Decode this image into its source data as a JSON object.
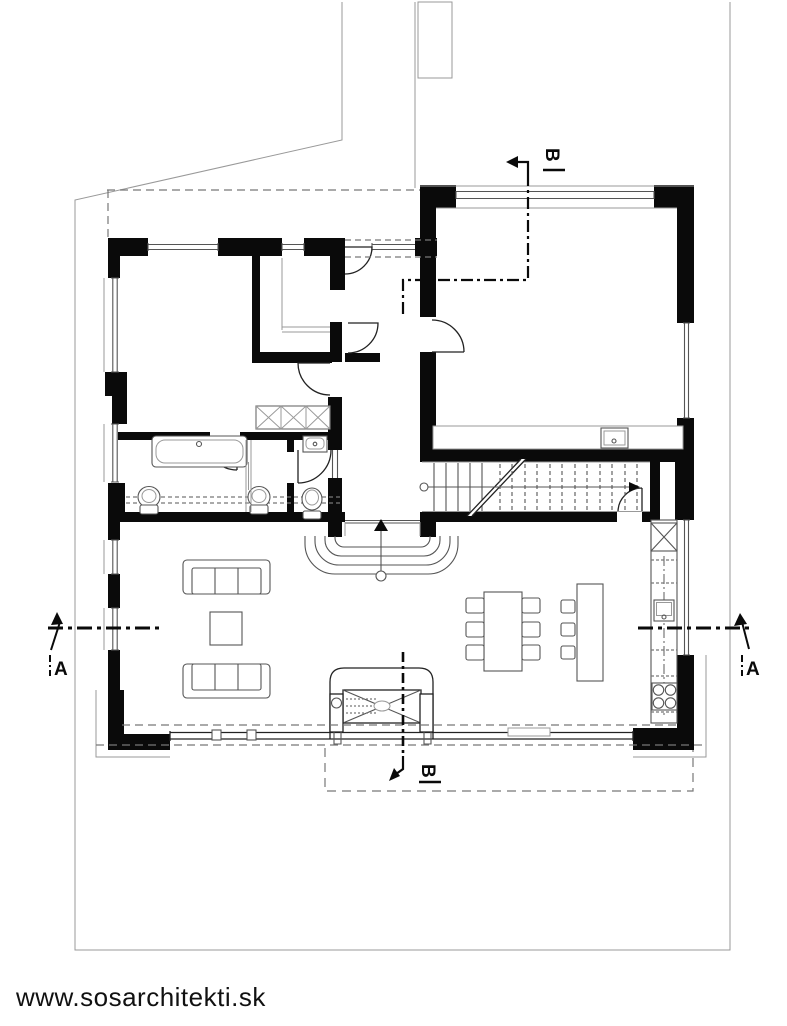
{
  "watermark": {
    "text": "www.sosarchitekti.sk"
  },
  "section_markers": {
    "a_left": {
      "label": "A"
    },
    "a_right": {
      "label": "A"
    },
    "b_top": {
      "label": "B"
    },
    "b_bottom": {
      "label": "B"
    }
  },
  "colors": {
    "wall": "#0a0a0a",
    "line_dark": "#222222",
    "line_mid": "#555555",
    "line_light": "#999999",
    "dash": "#777777",
    "background": "#ffffff"
  }
}
